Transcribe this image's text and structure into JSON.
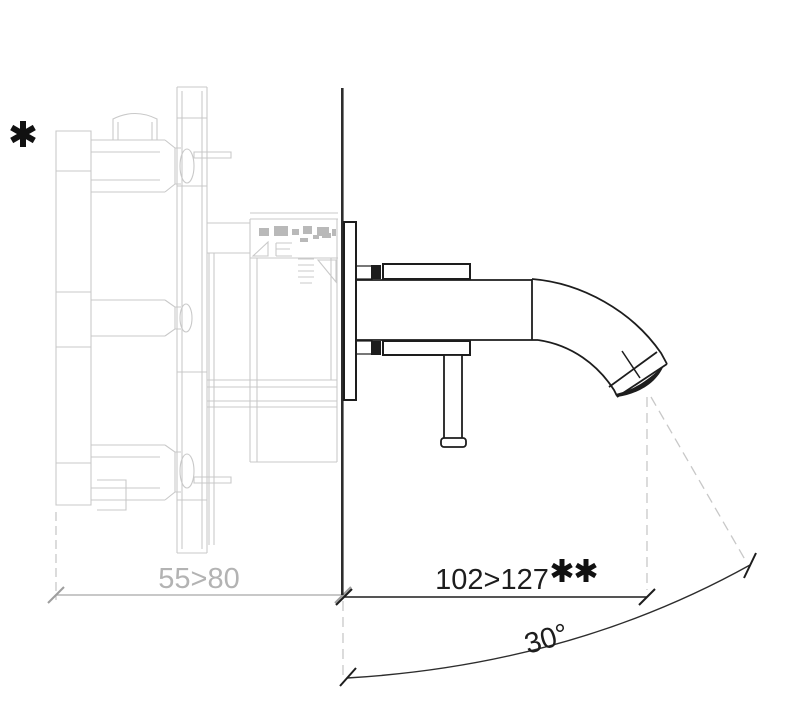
{
  "drawing": {
    "subject": "wall-mounted single-lever mixer tap - side elevation technical drawing",
    "annotations": {
      "footnote_marker": "*",
      "double_footnote_marker": "**",
      "concealed_depth_dimension": "55>80",
      "spout_projection_dimension": "102>127",
      "spout_angle": "30°"
    },
    "colors": {
      "background": "#ffffff",
      "concealed_part_lines": "#c9c9c9",
      "concealed_detail_fill": "#b9b9b9",
      "dimension_gray": "#a6a6a6",
      "dimension_text_gray": "#b3b3b3",
      "foreground_black": "#1d1d1d",
      "construction_dash": "#c8c8c8"
    }
  }
}
